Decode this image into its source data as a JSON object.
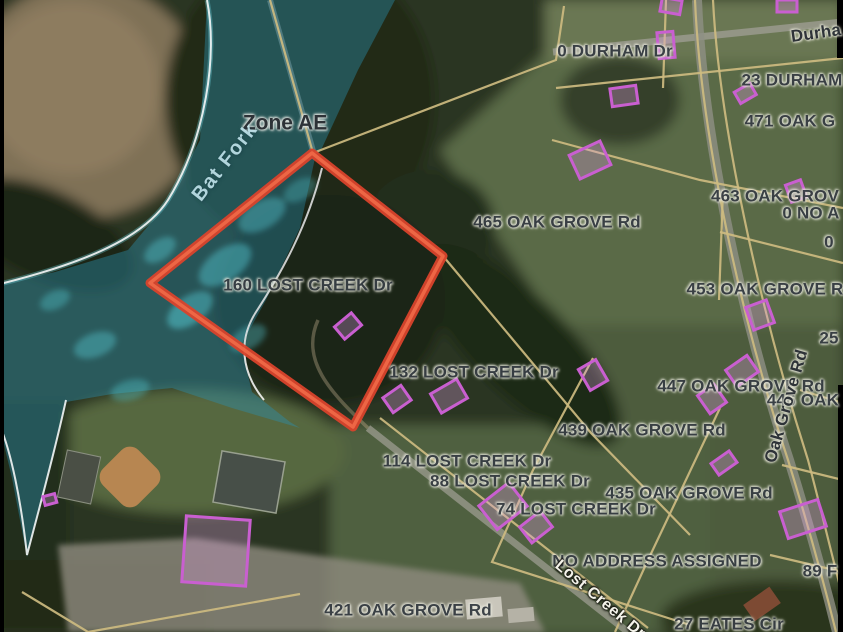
{
  "map": {
    "selected_parcel": {
      "address": "160 LOST CREEK Dr"
    },
    "flood_zone": {
      "designation": "Zone AE"
    },
    "creek_name": "Bat Fork",
    "labels": [
      {
        "id": "flood-zone-label",
        "text": "Zone AE",
        "x": 285,
        "y": 123,
        "r": 0,
        "cls": "zone"
      },
      {
        "id": "creek-name-label",
        "text": "Bat Fork",
        "x": 225,
        "y": 162,
        "r": -52,
        "cls": "creek"
      },
      {
        "id": "parcel-0-durham-dr",
        "text": "0 DURHAM Dr",
        "x": 615,
        "y": 51,
        "r": 0,
        "cls": "addr"
      },
      {
        "id": "road-durham-dr",
        "text": "Durha",
        "x": 816,
        "y": 33,
        "r": -8,
        "cls": "road-dark"
      },
      {
        "id": "parcel-23-durham",
        "text": "23 DURHAM",
        "x": 792,
        "y": 80,
        "r": 0,
        "cls": "addr"
      },
      {
        "id": "parcel-471-oak-grove",
        "text": "471 OAK G",
        "x": 790,
        "y": 121,
        "r": 0,
        "cls": "addr"
      },
      {
        "id": "parcel-465-oak-grove-rd",
        "text": "465 OAK GROVE Rd",
        "x": 557,
        "y": 222,
        "r": 0,
        "cls": "addr"
      },
      {
        "id": "parcel-463-oak-grove",
        "text": "463 OAK GROV",
        "x": 775,
        "y": 196,
        "r": 0,
        "cls": "addr"
      },
      {
        "id": "parcel-0-no-a",
        "text": "0 NO A",
        "x": 811,
        "y": 213,
        "r": 0,
        "cls": "addr"
      },
      {
        "id": "parcel-0",
        "text": "0",
        "x": 829,
        "y": 242,
        "r": 0,
        "cls": "addr"
      },
      {
        "id": "parcel-453-oak-grove-rd",
        "text": "453 OAK GROVE R",
        "x": 765,
        "y": 289,
        "r": 0,
        "cls": "addr"
      },
      {
        "id": "parcel-160-lost-creek-dr",
        "text": "160 LOST CREEK Dr",
        "x": 308,
        "y": 285,
        "r": 0,
        "cls": "addr"
      },
      {
        "id": "parcel-25",
        "text": "25",
        "x": 829,
        "y": 338,
        "r": 0,
        "cls": "addr"
      },
      {
        "id": "parcel-447-oak-grove-rd",
        "text": "447 OAK GROVE Rd",
        "x": 741,
        "y": 386,
        "r": 0,
        "cls": "addr"
      },
      {
        "id": "parcel-446-oak",
        "text": "446 OAK",
        "x": 803,
        "y": 400,
        "r": 0,
        "cls": "addr"
      },
      {
        "id": "road-oak-grove-rd",
        "text": "Oak Grove Rd",
        "x": 786,
        "y": 406,
        "r": -74,
        "cls": "road-dark"
      },
      {
        "id": "parcel-132-lost-creek-dr",
        "text": "132 LOST CREEK Dr",
        "x": 474,
        "y": 372,
        "r": 0,
        "cls": "addr"
      },
      {
        "id": "parcel-439-oak-grove-rd",
        "text": "439 OAK GROVE Rd",
        "x": 642,
        "y": 430,
        "r": 0,
        "cls": "addr"
      },
      {
        "id": "parcel-114-lost-creek-dr",
        "text": "114 LOST CREEK Dr",
        "x": 467,
        "y": 461,
        "r": 0,
        "cls": "addr"
      },
      {
        "id": "parcel-88-lost-creek-dr",
        "text": "88 LOST CREEK Dr",
        "x": 510,
        "y": 481,
        "r": 0,
        "cls": "addr"
      },
      {
        "id": "parcel-435-oak-grove-rd",
        "text": "435 OAK GROVE Rd",
        "x": 689,
        "y": 493,
        "r": 0,
        "cls": "addr"
      },
      {
        "id": "parcel-74-lost-creek-dr",
        "text": "74 LOST CREEK Dr",
        "x": 576,
        "y": 509,
        "r": 0,
        "cls": "addr"
      },
      {
        "id": "parcel-no-address-assigned",
        "text": "NO ADDRESS ASSIGNED",
        "x": 657,
        "y": 561,
        "r": 0,
        "cls": "addr"
      },
      {
        "id": "parcel-89-f",
        "text": "89 F",
        "x": 820,
        "y": 571,
        "r": 0,
        "cls": "addr"
      },
      {
        "id": "parcel-421-oak-grove-rd",
        "text": "421 OAK GROVE Rd",
        "x": 408,
        "y": 610,
        "r": 0,
        "cls": "addr"
      },
      {
        "id": "parcel-27-eates-cir",
        "text": "27 EATES Cir",
        "x": 729,
        "y": 624,
        "r": 0,
        "cls": "addr"
      },
      {
        "id": "road-lost-creek-dr",
        "text": "Lost Creek Dr",
        "x": 600,
        "y": 600,
        "r": 40,
        "cls": "road-light"
      }
    ],
    "colors": {
      "flood_overlay": "#2a90ad",
      "flood_boundary": "#ffffff",
      "selected_parcel_outline": "#df4a30",
      "parcel_line": "#cdbb80",
      "building_outline": "#c95fd0",
      "label_dark": "#383e44",
      "road_label_light": "#f4f3ea"
    }
  }
}
